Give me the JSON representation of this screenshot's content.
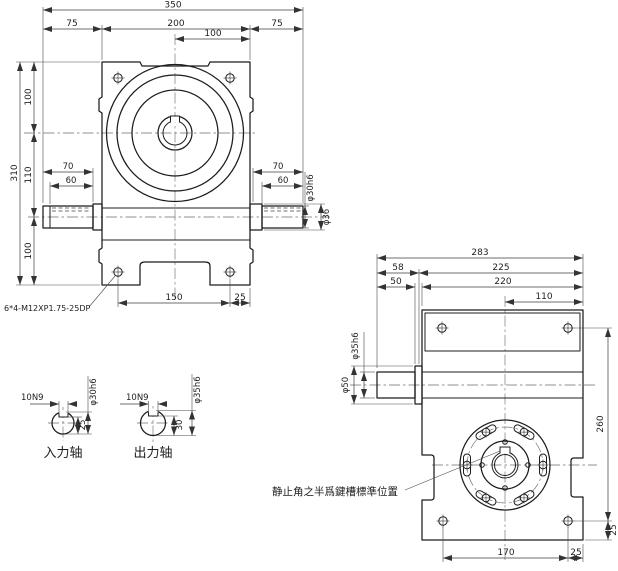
{
  "front": {
    "dim_overall_width": "350",
    "dim_left_75": "75",
    "dim_center_200": "200",
    "dim_right_75": "75",
    "dim_top_100": "100",
    "dim_h_100_top": "100",
    "dim_h_110": "110",
    "dim_h_100_bottom": "100",
    "dim_overall_height": "310",
    "dim_70_left": "70",
    "dim_60_left": "60",
    "dim_70_right": "70",
    "dim_60_right": "60",
    "dim_shaft_dia": "φ30h6",
    "dim_boss_dia": "φ36",
    "dim_bolt_span": "150",
    "dim_bolt_edge": "25",
    "note_tapped_holes": "6*4-M12XP1.75-25DP"
  },
  "sections": {
    "input": {
      "keyway": "10N9",
      "dia": "φ30h6",
      "depth": "25",
      "label": "入力轴"
    },
    "output": {
      "keyway": "10N9",
      "dia": "φ35h6",
      "depth": "30",
      "label": "出力轴"
    }
  },
  "side": {
    "dim_overall": "283",
    "dim_58": "58",
    "dim_225": "225",
    "dim_50": "50",
    "dim_220": "220",
    "dim_110": "110",
    "dim_shaft_dia": "φ35h6",
    "dim_boss_dia": "φ50",
    "dim_bolt_span_v": "260",
    "dim_bolt_edge_v": "25",
    "dim_bolt_span_h": "170",
    "dim_bolt_edge_h": "25",
    "note_keyway_position": "静止角之半爲鍵槽標準位置"
  },
  "colors": {
    "line": "#1c1c1c",
    "dim": "#3d3d3d",
    "background": "#ffffff"
  }
}
